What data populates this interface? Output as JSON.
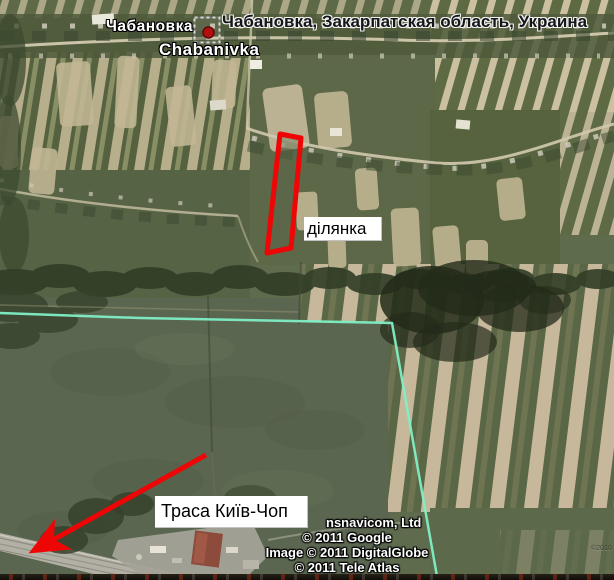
{
  "map": {
    "place": {
      "name_ru": "Чабановка",
      "name_translit": "Chabanivka",
      "full_title": "Чабановка, Закарпатская область, Украина"
    },
    "annotations": {
      "plot_label": "ділянка",
      "highway_label": "Траса Київ-Чоп"
    },
    "attribution": {
      "provider_partial": "nsnavicom, Ltd",
      "google": "© 2011 Google",
      "imagery": "Image © 2011 DigitalGlobe",
      "tele_atlas": "© 2011 Tele Atlas",
      "image_watermark": "©2010"
    },
    "colors": {
      "annotation_red": "#ee0505",
      "boundary_cyan": "#7fefc5",
      "placemark_red": "#b01010",
      "label_bg": "#ffffff",
      "label_text": "#000000"
    }
  }
}
